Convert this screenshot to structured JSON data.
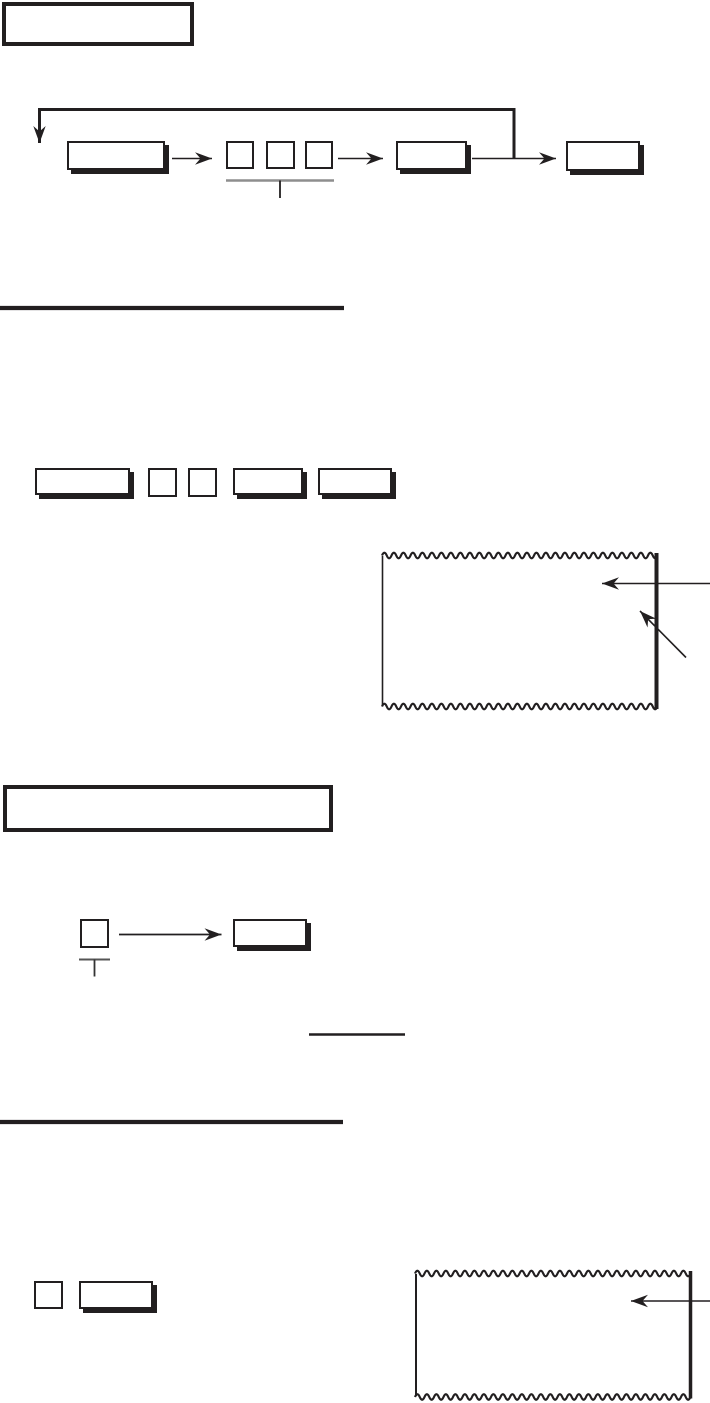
{
  "page": {
    "background": "#ffffff",
    "ink": "#221f20",
    "gray_rule": "#8e8e8e",
    "visible_text": ""
  },
  "figure_top_flow": {
    "title_box_text": "",
    "step_key_1_label": "",
    "digit_boxes": [
      "",
      "",
      ""
    ],
    "step_key_2_label": "",
    "step_key_3_label": ""
  },
  "figure_key_sequence": {
    "key_wide_label": "",
    "digit_boxes": [
      "",
      ""
    ],
    "key_a_label": "",
    "key_b_label": "",
    "receipt_text": ""
  },
  "figure_single_key": {
    "title_box_text": "",
    "digit_box": "",
    "key_label": ""
  },
  "figure_bottom": {
    "digit_box": "",
    "key_label": "",
    "receipt_text": ""
  }
}
